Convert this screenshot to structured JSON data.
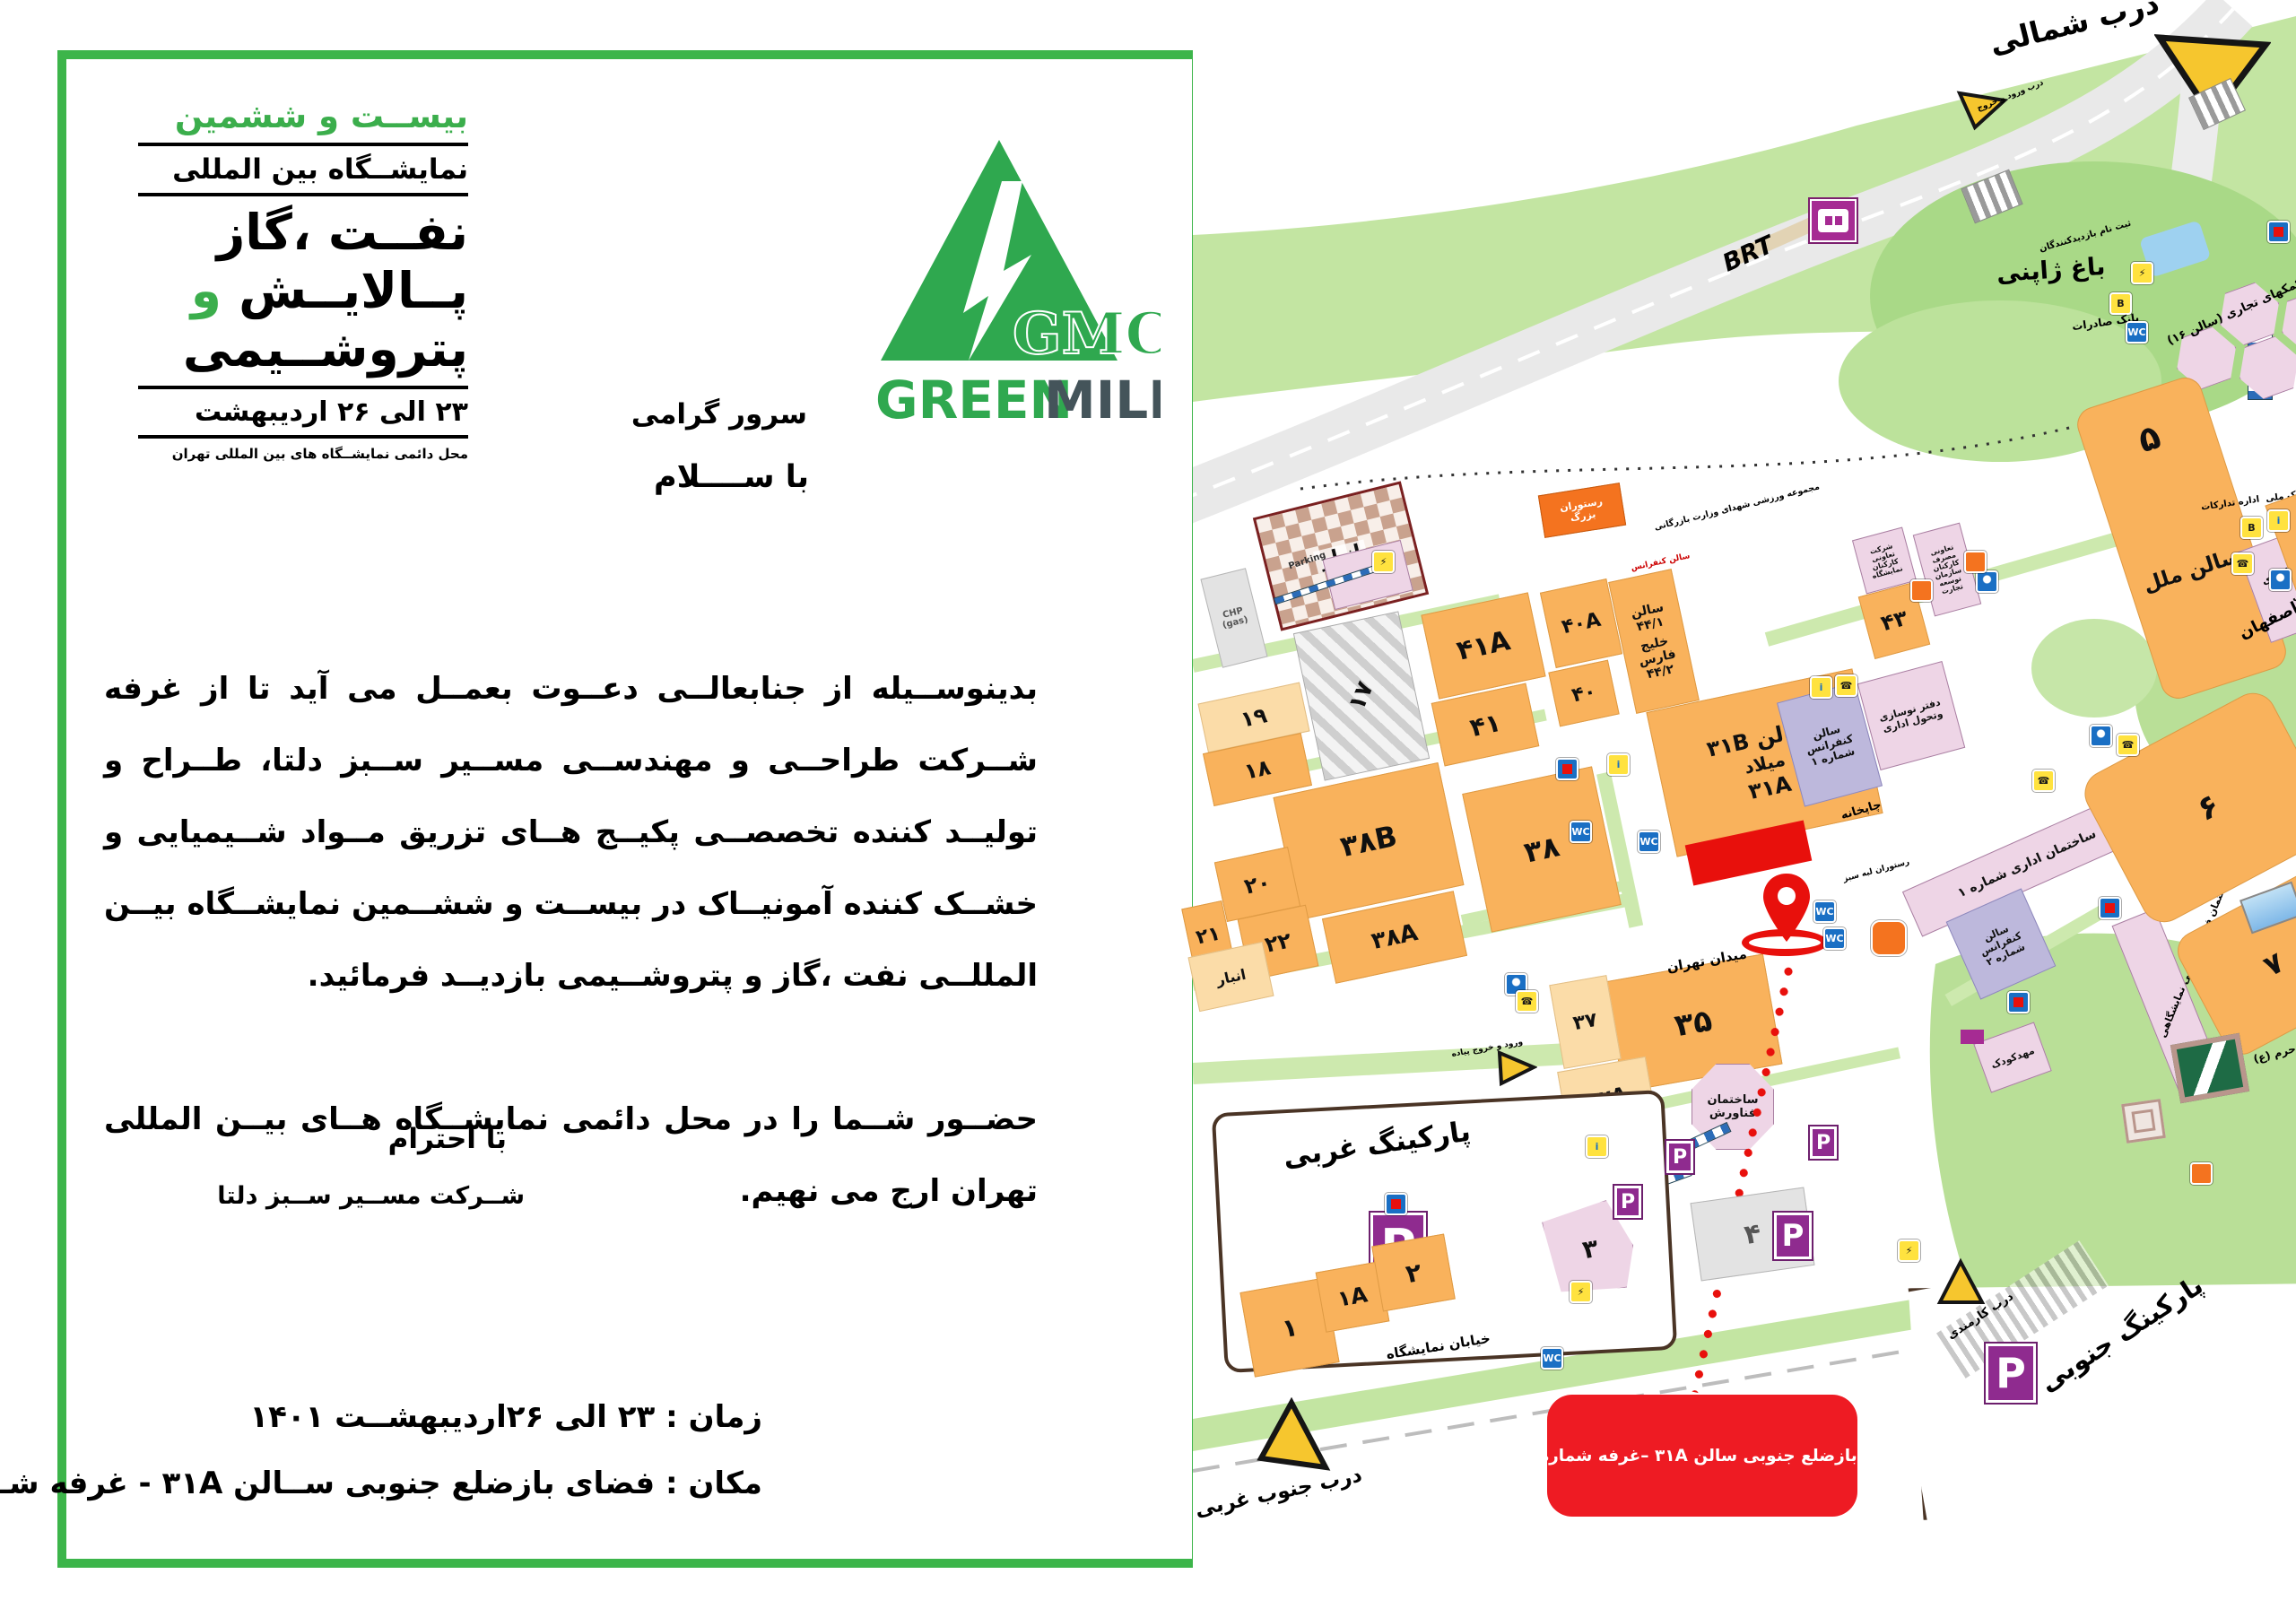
{
  "letter": {
    "header_block": {
      "line1": "بیســت و ششمین",
      "line2": "نمایشــگاه بین المللی",
      "line3": "نفــت ،گاز",
      "line4_black": "پــالایــش",
      "line4_green": "و",
      "line5": "پتروشــیمی",
      "line6": "۲۳ الی ۲۶ اردیبهشت",
      "line7": "محل دائمی نمایشــگاه های بین المللی تهران"
    },
    "logo": {
      "gmc": "GMC",
      "green": "GREEN",
      "mile": "MILE"
    },
    "salutation": "سرور گرامی",
    "greeting": "با ســــلام",
    "body_par1": "بدینوســیله از جنابعالــی دعــوت بعمــل می آید تا از غرفه شــرکت طراحــی و مهندســی مســیر ســبز دلتا، طــراح و تولیــد کننده تخصصــی پکیــج هــای تزریق مــواد شــیمیایی و خشــک کننده آمونیــاک در بیســت و ششــمین نمایشــگاه بیــن المللــی نفت ،گاز و پتروشــیمی بازدیــد فرمائید.",
    "body_par2": "حضــور شــما را در محل دائمی نمایشــگاه هــای بیــن المللی تهران ارج می نهیم.",
    "regards": "با احترام",
    "company": "شــرکت مســیر ســبز دلتا",
    "time_line": "زمان : ۲۳ الی ۲۶اردیبهشــت ۱۴۰۱",
    "place_line": "مکان : فضای بازضلع جنوبی ســالن ۳۱A - غرفه شــماره ۴۳۰۶"
  },
  "map": {
    "gates": {
      "north": "درب شمالی",
      "north_sub": "درب\nورود و خروج",
      "southwest": "درب\nجنوب غربی",
      "staff": "درب کارمندی",
      "ped": "ورود و خروج\nپیاده"
    },
    "brt": "BRT",
    "streets": {
      "exhibition": "خیابان نمایشگاه"
    },
    "parkings": {
      "west": "پارکینگ غربی",
      "south": "پارکینگ جنوبی",
      "p": "P",
      "parking_en": "Parking"
    },
    "icons": {
      "wc": "WC",
      "info": "i",
      "phone": "☎",
      "elec": "⚡",
      "bank": "B"
    },
    "halls": {
      "h41a": "۴۱A",
      "h41": "۴۱",
      "h40a": "۴۰A",
      "h40": "۴۰",
      "h44_1": "سالن ۴۴/۱",
      "h44_2": "خلیج فارس ۴۴/۲",
      "h44_conf": "سالن کنفرانس",
      "h43": "۴۳",
      "h19": "۱۹",
      "h18": "۱۸",
      "h17": "۱۷",
      "h38b": "۳۸B",
      "h38": "۳۸",
      "h38a": "۳۸A",
      "h20": "۲۰",
      "h21": "۲۱",
      "h22": "۲۲",
      "h35": "۳۵",
      "h37": "۳۷",
      "h37a": "۳۷A",
      "h31b": "سالن ۳۱B",
      "h31_milad": "میلاد",
      "h31a": "۳۱A",
      "h5": "۵",
      "h5_name": "سالن ملل",
      "h6": "۶",
      "h7": "۷",
      "h27": "۲۷",
      "h1": "۱",
      "h1a": "۱A",
      "h2": "۲",
      "h3": "۳",
      "h4": "۴",
      "anbar": "انبار",
      "anbar2": "انبار",
      "chp": "CHP\n(gas)"
    },
    "buildings": {
      "big_restaurant": "رستوران\nبزرگ",
      "japanese_garden": "باغ ژاپنی",
      "hall16": "معاونت کمکهای تجاری\n(سالن ۱۶)",
      "bank_saderat": "بانک صادرات",
      "registration": "ثبت نام\nبازدیدکنندگان",
      "sports": "مجموعه ورزشی شهدای\nوزارت بازرگانی",
      "coop1": "شرکت\nتعاونی\nکارکنان\nنمایشگاه",
      "coop2": "تعاونی\nمصرف\nکارکنان\nسازمان\nتوسعه\nتجارت",
      "conf1": "سالن\nکنفرانس\nشماره ۱",
      "renovation": "دفتر نوسازی\nوتحول اداری",
      "print_house": "چاپخانه",
      "admin1": "ساختمان اداری شماره ۱",
      "conf2": "سالن\nکنفرانس\nشماره ۲",
      "eng": "ساختمان فنی، مهندسی\nنمایشگاهی",
      "admin2": "ساختمان اداری\nشماره ۲\nرفاهی",
      "tadarokat": "اداره تدارکات",
      "bank_melli": "بانک\nملی",
      "esfahan": "تالار اصفهان",
      "tehran_sq": "میدان تهران",
      "green_rest": "رستوران\nلبه سبز",
      "fanavaresh": "ساختمان\nفناورش",
      "services": "واحد خدمات فنی\nپیمانکاری",
      "kindergarten": "مهدکودک",
      "shrine": "حرم (ع)"
    },
    "callout": "فضای بازضلع جنوبی سالن ۳۱A  –غرفه شماره ۴۳۰۶"
  }
}
